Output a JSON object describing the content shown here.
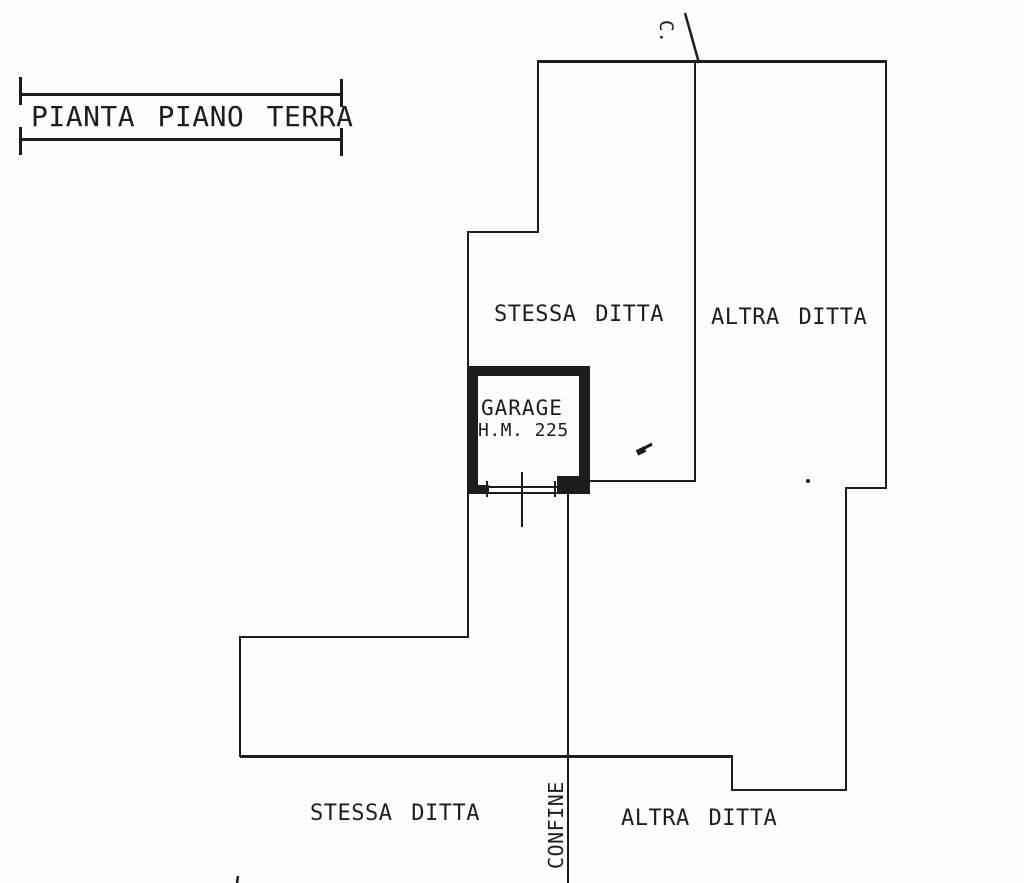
{
  "page": {
    "paper_color": "#fdfdfc",
    "ink_color": "#1d1d1b"
  },
  "title_block": {
    "title": "PIANTA PIANO TERRA"
  },
  "plan": {
    "corner_label": "C.",
    "upper": {
      "left_parcel": "STESSA DITTA",
      "right_parcel": "ALTRA DITTA"
    },
    "garage": {
      "name": "GARAGE",
      "height_note": "H.M. 225"
    },
    "lower": {
      "left_parcel": "STESSA DITTA",
      "right_parcel": "ALTRA DITTA"
    },
    "boundary_label": "CONFINE"
  }
}
